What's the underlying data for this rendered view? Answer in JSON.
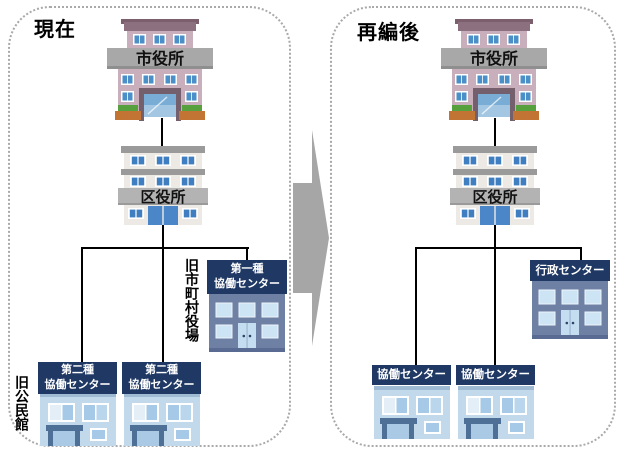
{
  "left_panel": {
    "title": "現在",
    "city_hall_sign": "市役所",
    "ward_office_sign": "区役所",
    "type1_center": {
      "line1": "第一種",
      "line2": "協働センター"
    },
    "type2_center_a": {
      "line1": "第二種",
      "line2": "協働センター"
    },
    "type2_center_b": {
      "line1": "第二種",
      "line2": "協働センター"
    },
    "note_former_town_hall": "旧市町村役場",
    "note_former_community_hall": "旧公民館"
  },
  "right_panel": {
    "title": "再編後",
    "city_hall_sign": "市役所",
    "ward_office_sign": "区役所",
    "center_a": "協働センター",
    "center_b": "協働センター",
    "admin_center": "行政センター"
  },
  "colors": {
    "banner_navy": "#1f3864",
    "arrow_gray": "#a6a6a6",
    "city_hall_wall_pink": "#c9aebc",
    "ward_office_wall": "#edeae5",
    "blue_house_wall": "#c2d8eb",
    "dark_building_wall": "#6e80a4",
    "sign_gray": "#a8a8a8",
    "connector_black": "#000000",
    "panel_border_gray": "#a9a9a9"
  }
}
